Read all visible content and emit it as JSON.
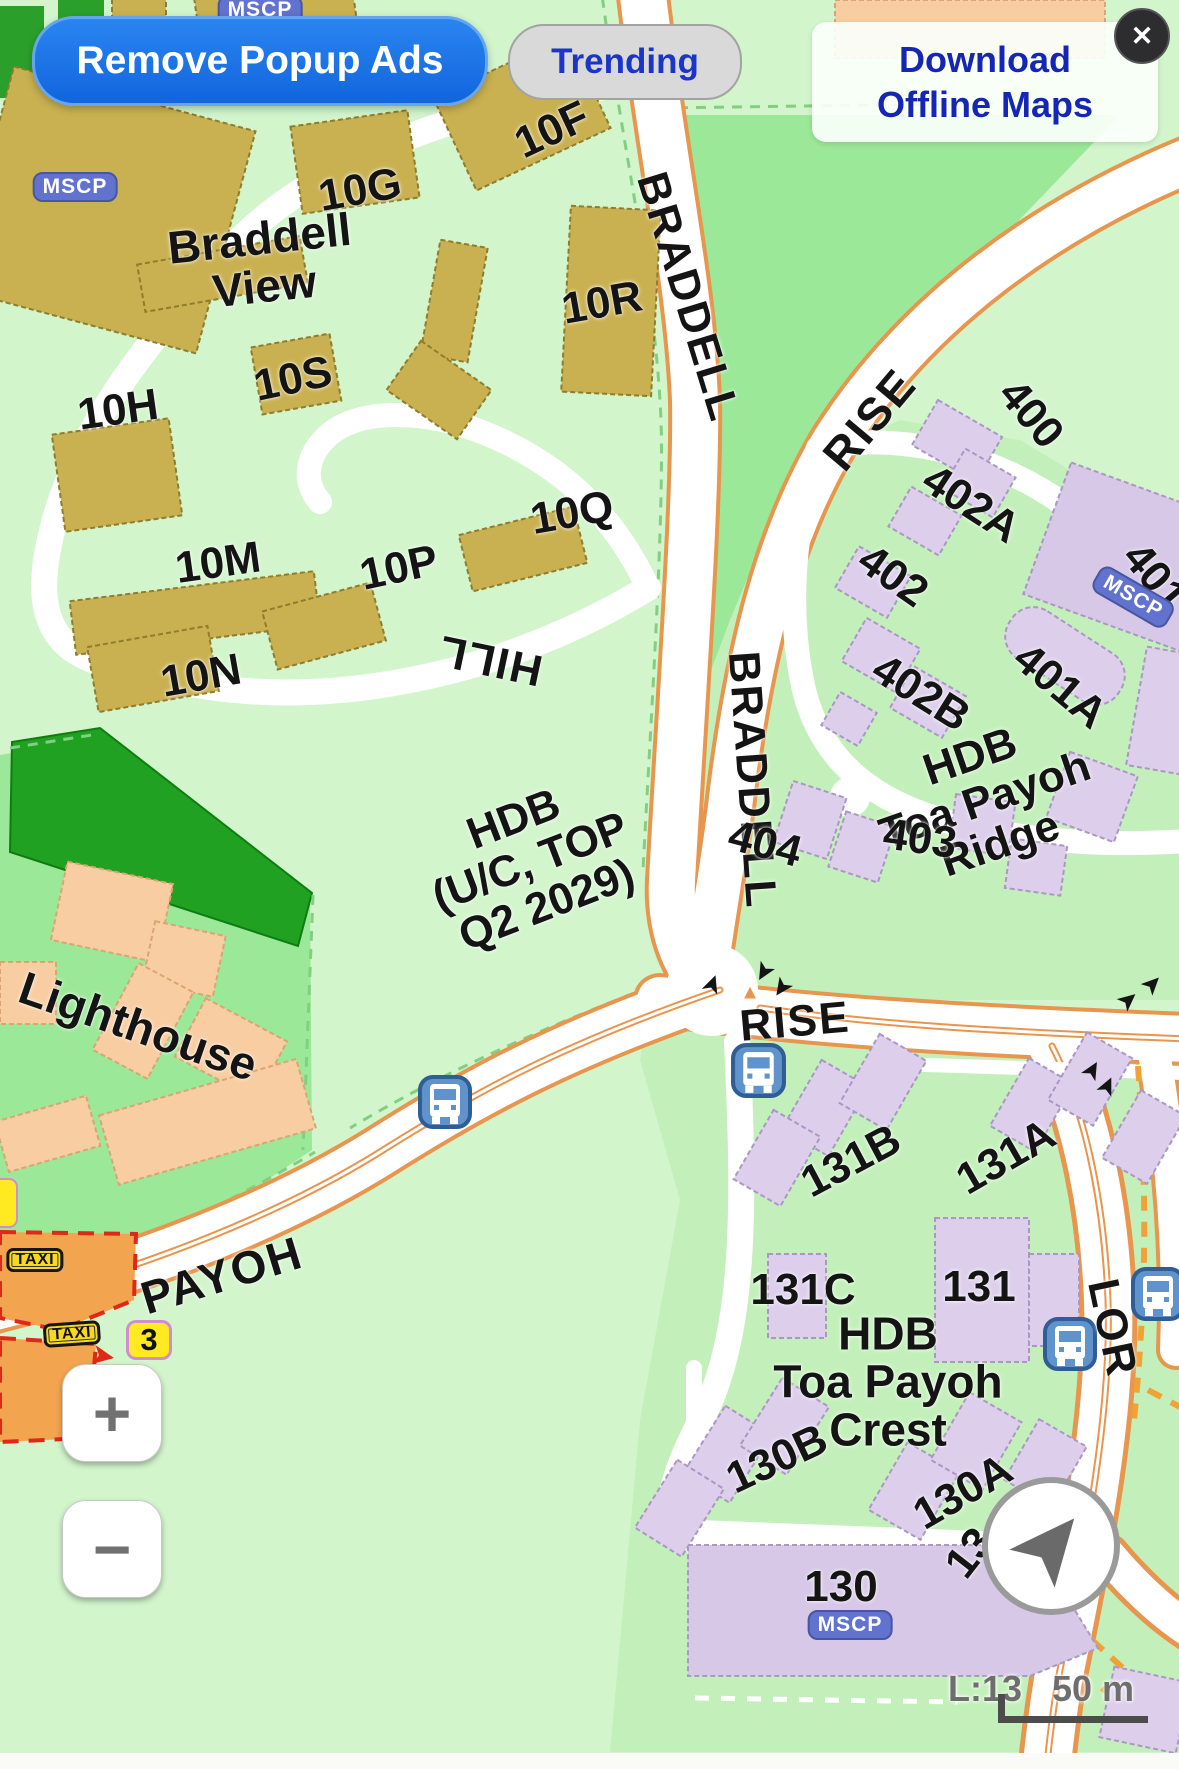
{
  "overlay": {
    "remove_ads": "Remove Popup Ads",
    "trending": "Trending",
    "download_line1": "Download",
    "download_line2": "Offline Maps",
    "close": "✕"
  },
  "zoom_controls": {
    "zoom_in": "+",
    "zoom_out": "−"
  },
  "scale": {
    "level": "L:13",
    "distance": "50 m"
  },
  "badges": {
    "mscp": "MSCP",
    "taxi": "TAXI",
    "bus_route": "3"
  },
  "roads": {
    "braddell": "BRADDELL",
    "rise": "RISE",
    "hill": "HILL",
    "payoh": "PAYOH",
    "lor": "LOR"
  },
  "areas": {
    "braddell_view": {
      "l1": "Braddell",
      "l2": "View"
    },
    "hdb_uc": {
      "l1": "HDB",
      "l2": "(U/C, TOP",
      "l3": "Q2 2029)"
    },
    "ridge": {
      "l1": "HDB",
      "l2": "Toa Payoh",
      "l3": "Ridge"
    },
    "lighthouse": "Lighthouse",
    "crest": {
      "l1": "HDB",
      "l2": "Toa Payoh",
      "l3": "Crest"
    }
  },
  "blocks": {
    "b10g": "10G",
    "b10f": "10F",
    "b10r": "10R",
    "b10s": "10S",
    "b10h": "10H",
    "b10m": "10M",
    "b10q": "10Q",
    "b10p": "10P",
    "b10n": "10N",
    "b400": "400",
    "b402a": "402A",
    "b402": "402",
    "b401": "401",
    "b402b": "402B",
    "b401a": "401A",
    "b404": "404",
    "b403": "403",
    "b131b": "131B",
    "b131a": "131A",
    "b131c": "131C",
    "b131": "131",
    "b130b": "130B",
    "b130a": "130A",
    "b130": "130",
    "b13partial": "13"
  }
}
